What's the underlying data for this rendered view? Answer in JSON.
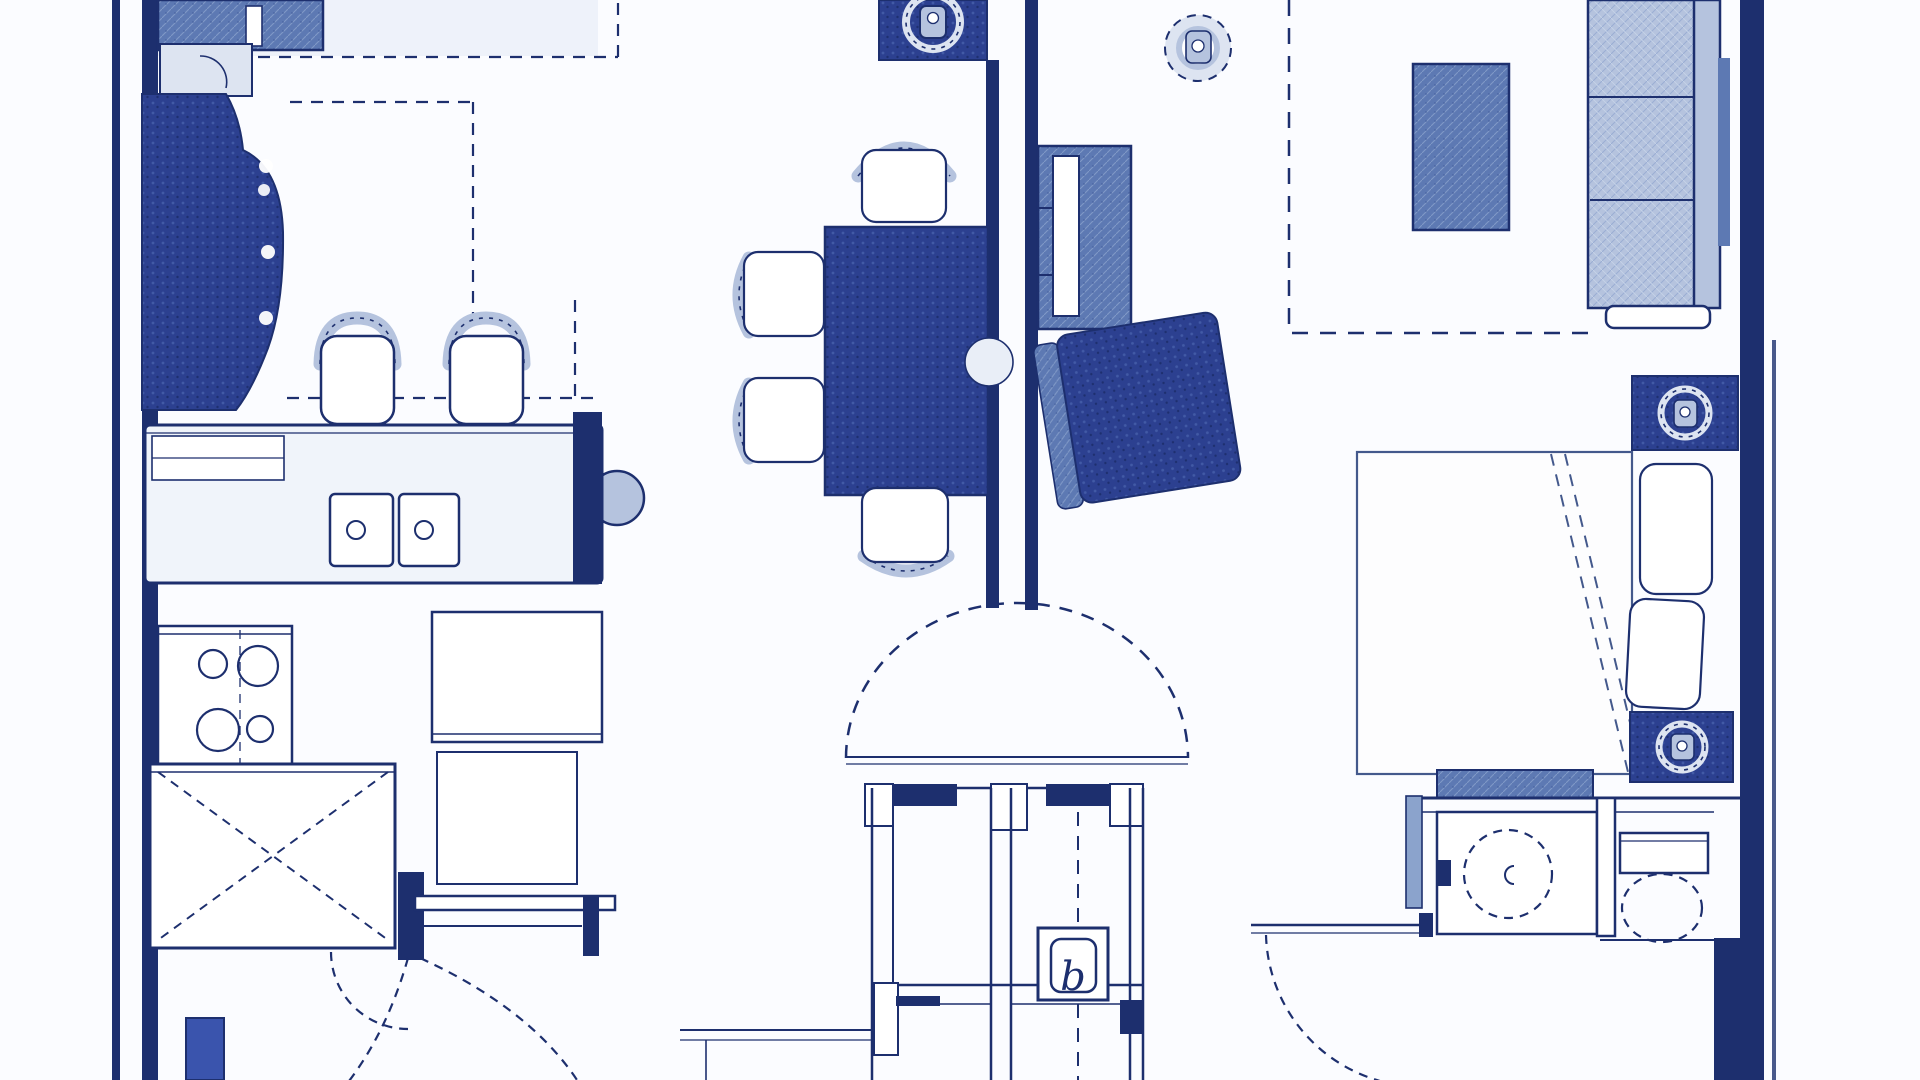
{
  "meta": {
    "title": "Residential unit floor plan (blueprint scan)",
    "drawing_type": "floor-plan"
  },
  "labels": {
    "closet_b": "b"
  },
  "colors": {
    "paper": "#fbfcff",
    "line": "#1d2f6e",
    "dark": "#2c4090",
    "medium": "#5d79b3",
    "light": "#b5c3de",
    "pale": "#dde4f1",
    "accent": "#3a54ad",
    "soft_line": "#44598c"
  },
  "rooms": [
    {
      "name": "kitchen",
      "items": [
        "refrigerator",
        "corner-cabinet",
        "curved-breakfast-bar",
        "bar-stool",
        "bar-stool",
        "counter-with-double-sink",
        "range-cooktop-4-burners",
        "upper-cabinets-dashed-outline",
        "utility-closet-x",
        "work-table",
        "storage-cabinet",
        "wall-shelf",
        "entry-door-swings"
      ]
    },
    {
      "name": "dining-area",
      "items": [
        "ceiling-light-fixture",
        "dining-table",
        "dining-chair",
        "dining-chair",
        "dining-chair",
        "dining-chair",
        "wall-sconce-notch"
      ]
    },
    {
      "name": "living-area",
      "items": [
        "media-console-with-tv",
        "ceiling-fan-light",
        "armchair",
        "coffee-table",
        "three-seat-sofa",
        "dashed-soffit-boundary"
      ]
    },
    {
      "name": "entry-foyer",
      "items": [
        "arched-alcove-dome",
        "coat-closet",
        "mechanical-closet-b",
        "door-swing-arc"
      ]
    },
    {
      "name": "bedroom",
      "items": [
        "bed-with-folded-blanket",
        "pillow",
        "pillow",
        "nightstand-light",
        "nightstand-light",
        "bedroom-door-swing"
      ]
    },
    {
      "name": "bathroom",
      "items": [
        "vanity-counter-backsplash",
        "vanity-sink",
        "toilet"
      ]
    }
  ]
}
